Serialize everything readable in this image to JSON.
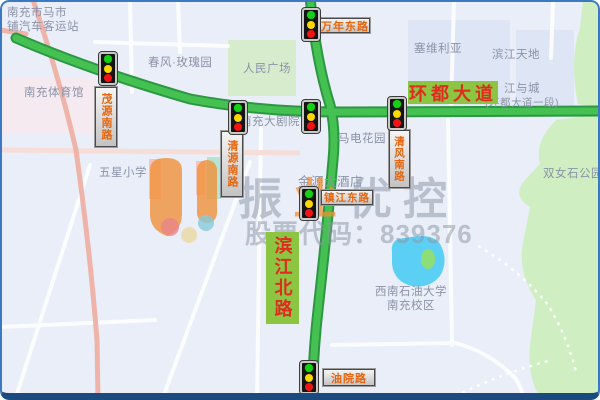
{
  "watermark": {
    "brand_chars": [
      "振",
      "业",
      "优",
      "控"
    ],
    "stock_line": "股票代码：839376"
  },
  "road_labels": {
    "huandu_avenue": "环都大道",
    "binjiang_north": "滨江北路"
  },
  "signal_signs": {
    "maoyuan_south": "茂源南路",
    "qingyuan_south": "清源南路",
    "wannian_east": "万年东路",
    "qingfeng_south": "清风南路",
    "zhenjiang_east": "镇江东路",
    "youyuan": "油院路"
  },
  "poi": {
    "bus_station_line1": "南充市马市",
    "bus_station_line2": "铺汽车客运站",
    "gymnasium": "南充体育馆",
    "rose_garden": "春风·玫瑰园",
    "peoples_square": "人民广场",
    "wuxing_school": "五星小学",
    "grand_theater": "南充大剧院",
    "madian_garden": "马电花园",
    "hotel": "金源大酒店",
    "sevilla": "塞维利亚",
    "binjiang_tiandi": "滨江天地",
    "jiangyucheng_line1": "江与城",
    "jiangyucheng_line2": "(环都大道一段)",
    "shuangnvshi_park": "双女石公园",
    "swpu_line1": "西南石油大学",
    "swpu_line2": "南充校区"
  },
  "colors": {
    "road_green": "#45c152",
    "road_green_border": "#2c9742",
    "label_green_bg": "#8bc541",
    "label_red_text": "#e02b20",
    "sign_text_orange": "#e8650d",
    "watermark_grey": "#8d95a4",
    "watermark_orange": "#ef8f35",
    "lake_blue": "#5bd0f4",
    "park_green": "#cfeec2",
    "frame_blue": "#3b79c2"
  }
}
